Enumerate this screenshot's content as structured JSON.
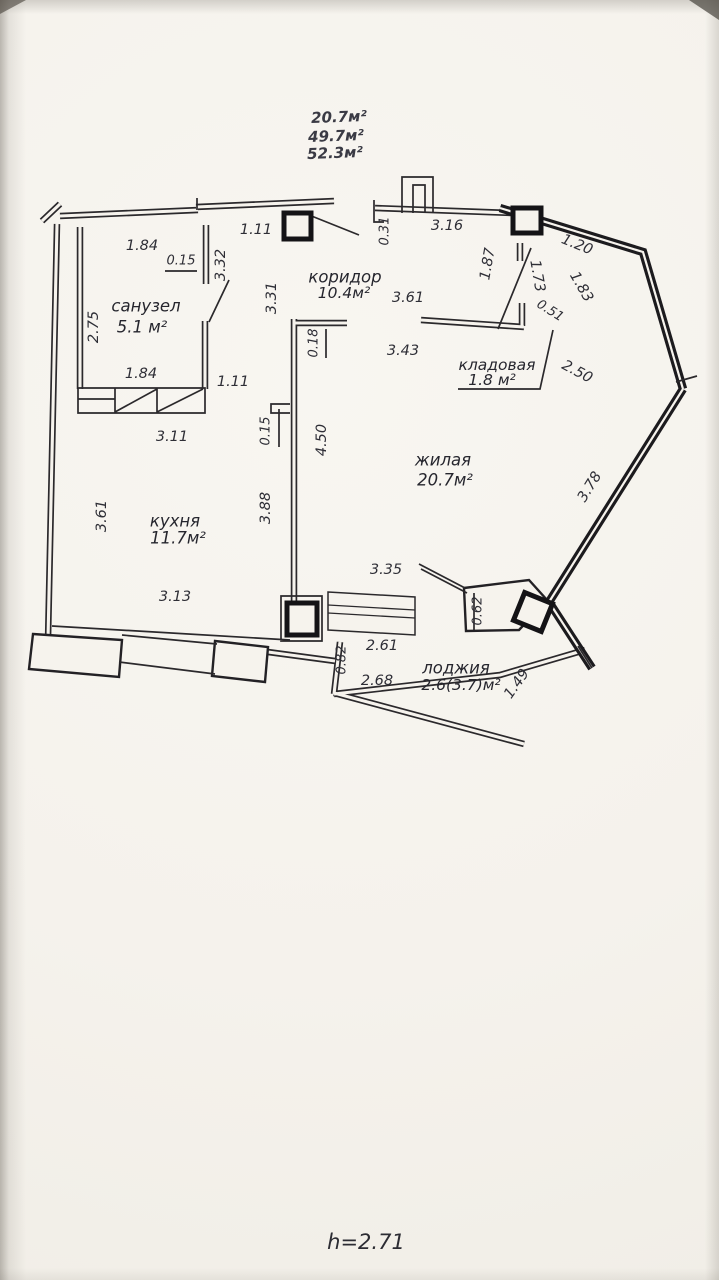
{
  "labels": {
    "summary": [
      "20.7м²",
      "49.7м²",
      "52.3м²"
    ],
    "rooms": [
      {
        "name": "санузел",
        "area": "5.1 м²"
      },
      {
        "name": "коридор",
        "area": "10.4м²"
      },
      {
        "name": "кладовая",
        "area": "1.8 м²"
      },
      {
        "name": "жилая",
        "area": "20.7м²"
      },
      {
        "name": "кухня",
        "area": "11.7м²"
      },
      {
        "name": "лоджия",
        "area": "2.6(3.7)м²"
      }
    ],
    "height_note": "h=2.71",
    "dims": {
      "bath_top_width": "1.84",
      "bath_top_offset": "0.15",
      "entry_top_opening": "1.11",
      "bath_right_height": "3.32",
      "corridor_height": "3.31",
      "bath_left_height": "2.75",
      "bath_bottom_width": "1.84",
      "kitchen_pass_opening": "1.11",
      "kitchen_top_width": "3.11",
      "central_wall_offset_top": "0.18",
      "central_wall_offset_mid": "0.15",
      "living_wall_height": "4.50",
      "kitchen_right_height": "3.88",
      "kitchen_left_height": "3.61",
      "kitchen_bottom_width": "3.13",
      "hall_vent_offset": "0.31",
      "hall_top_width": "3.16",
      "entry_door_width": "1.87",
      "closet_top_width": "3.61",
      "living_top_width": "3.43",
      "wall_right_1": "1.20",
      "wall_right_2": "1.73",
      "wall_right_3": "1.83",
      "closet_door_width": "0.51",
      "wall_right_4": "2.50",
      "living_right_height": "3.78",
      "living_bottom_width": "3.35",
      "loggia_window_width": "2.61",
      "loggia_left_depth": "0.82",
      "loggia_bottom_width": "2.68",
      "loggia_pier_width": "0.62",
      "loggia_right_side": "1.49"
    }
  }
}
